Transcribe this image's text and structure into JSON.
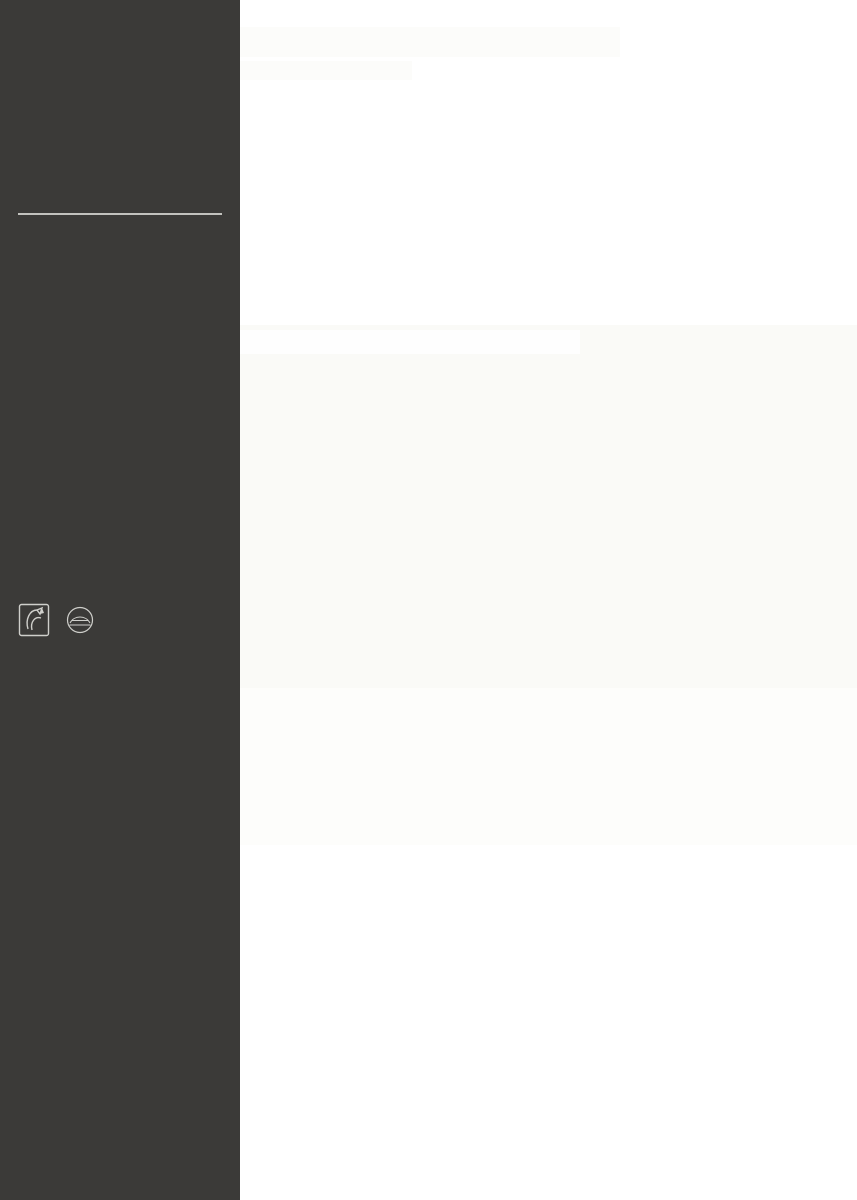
{
  "colors": {
    "accent": "#ccd31e",
    "bright_yellow": "#eeea10",
    "olive": "#a9ac44",
    "sidebar_bg": "#3b3a38",
    "legend_existing": "#a9ac44",
    "legend_planned": "#e8ed0b"
  },
  "sidebar": {
    "title": "CENTRAL SQUARE",
    "subtitle": "Jednostka 11",
    "description": "Otoczenie Podkarpackiego Urzędu Wojewódzkiego. Założeniem projektu jednostki jest przeprojektowanie na funkcję reprezentacyjną i rekreacyjną, placu parkingowego, który wypełnia całą działkę. Parking znajdował się będzie pod powierzchnią terenu.",
    "swot": {
      "heading": "Analiza SWOT",
      "table_title": "MOCNE I SŁABE STRONY JEDNOSTKI 11",
      "rows": [
        {
          "label": "Funkcjonalność",
          "items": [
            "-parking Podkarpackiego Urzędu Wojewódzkiego",
            "-strefa wejściowa Podkarpackiego Urzędu Wojewódzkiego"
          ],
          "rating": 2,
          "rating_max": 5
        },
        {
          "label": "Kompozycja przestrzenna",
          "items": [
            "-wybetonowany prostokątny parking"
          ],
          "rating": 1,
          "rating_max": 5
        },
        {
          "label": "Komunikacja",
          "items": [
            "-komunikacja ograniczona, parking płatny",
            "-brak powiązania z parkingiem pod Ogrodami Bernardyńskimi"
          ],
          "rating": 2,
          "rating_max": 5
        },
        {
          "label": "Wartości przyrodnicze",
          "items": [
            "-obecność niewielkiej ilości drzew",
            "- widok na bluszcz opuszczający się z terenu ogrodu"
          ],
          "rating": 2,
          "rating_max": 5
        },
        {
          "label": "Wartości kulturowe",
          "items": [
            "-w sąsiedztwie znajduje się klasztor bernardynów"
          ],
          "rating": 2,
          "rating_max": 5
        },
        {
          "label": "Wartości estetyczne",
          "items": [
            "-otoczenie parkingu zielenią ogrodu podnosi jakość miejsca"
          ],
          "rating": 2,
          "rating_max": 5
        },
        {
          "label": "Podsumowanie",
          "items": [
            "-nieduży słabo zaplanowany i niezadbany parking",
            "-brak powiązania z sąsiadującą strefą postojową"
          ],
          "rating": null,
          "rating_max": 5
        },
        {
          "label": "Zaplanowane działania naprawcze",
          "items": [
            "-przeniesienie strefy parkingowej pod powierzchnię terenu",
            "-zagospodarowanie terenu w nawiązaniu do istniejących Ogrodów Bernardyńskich",
            "-zainstalowanie drewnianego tunelu wzdłuż drogi"
          ],
          "rating": null,
          "rating_max": 5
        }
      ]
    },
    "legend": [
      {
        "label": "-istniejące",
        "color": "#a9ac44"
      },
      {
        "label": "-projektowane",
        "color": "#e8ed0b"
      }
    ],
    "sections": [
      {
        "title": "Schwarzplan",
        "scale": "1:5000"
      },
      {
        "title": "Schemat komunikacji",
        "scale": "1:5000"
      },
      {
        "title": "Schemat zieleni",
        "scale": "1:5000"
      }
    ],
    "map_marker": "P",
    "logos": [
      {
        "lines": [
          "POLITECHNIKA",
          "RZESZOWSKA"
        ],
        "sub": "im. IGNACEGO ŁUKASIEWICZA"
      },
      {
        "lines": [
          "WYDZIAŁ",
          "BUDOWNICTWA,",
          "INŻYNIERII ŚRODOWISKA",
          "I ARCHITEKTURY"
        ],
        "sub": "POLITECHNIKA RZESZOWSKA"
      }
    ]
  },
  "main": {
    "hero": {
      "title": "ŚRÓDMIEJSKI PIERŚCIEŃ ZIELENI RZESZOWA",
      "subtitle": "Wnętrze architektoniczne",
      "dots": 13
    },
    "siteplan": {
      "title": "Zagospodarowanie",
      "scale": "skala 1:1000",
      "compass": [
        "N",
        "E",
        "S",
        "W"
      ],
      "markers": [
        "A",
        "B"
      ]
    },
    "widoki": {
      "title": "Widoki",
      "scale": "skala 1:1000",
      "labels": [
        "A-A",
        "B-B"
      ]
    },
    "footer": {
      "degree": "PRACA DYPLOMOWA MAGISTERSKA",
      "author": "AUTOR: INŻ. ARCH. MARCIN ZIOBRO",
      "promoter": "PROMOTOR: DR INŻ. ARCH. JOANNA DUDEK"
    }
  }
}
